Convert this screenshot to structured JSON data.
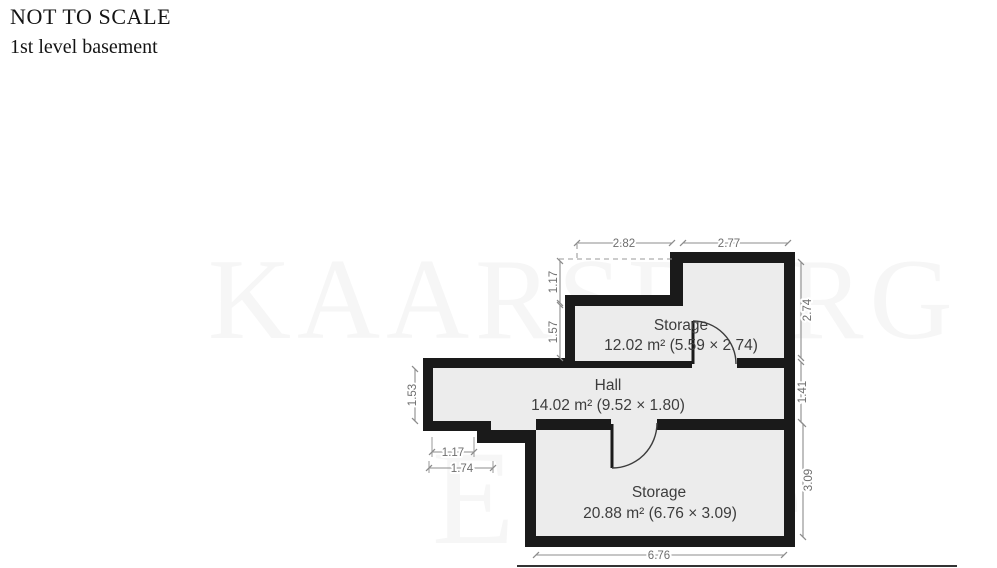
{
  "page": {
    "title": "NOT TO SCALE",
    "subtitle": "1st level basement"
  },
  "watermark": {
    "word1": "KAARSBERG",
    "word2": "Estate"
  },
  "floorplan": {
    "rooms": [
      {
        "id": "storage-upper",
        "name": "Storage",
        "area_label": "12.02 m² (5.59 × 2.74)"
      },
      {
        "id": "hall",
        "name": "Hall",
        "area_label": "14.02 m² (9.52 × 1.80)"
      },
      {
        "id": "storage-lower",
        "name": "Storage",
        "area_label": "20.88 m² (6.76 × 3.09)"
      }
    ],
    "dimensions": {
      "top_left_width": "2.82",
      "top_right_width": "2.77",
      "upper_left_offset": "1.17",
      "upper_left_height": "1.57",
      "hall_left_height": "1.53",
      "right_upper_height": "2.74",
      "right_mid_height": "1.41",
      "right_lower_height": "3.09",
      "notch_width_inner": "1.17",
      "notch_width_outer": "1.74",
      "bottom_width": "6.76"
    }
  },
  "colors": {
    "background": "#ffffff",
    "wall": "#1a1a1a",
    "floor": "#ececec",
    "dimension_line": "#8c8c8c",
    "dimension_text": "#6e6e6e",
    "room_text": "#3d3d3d",
    "watermark": "#f6f6f6"
  }
}
